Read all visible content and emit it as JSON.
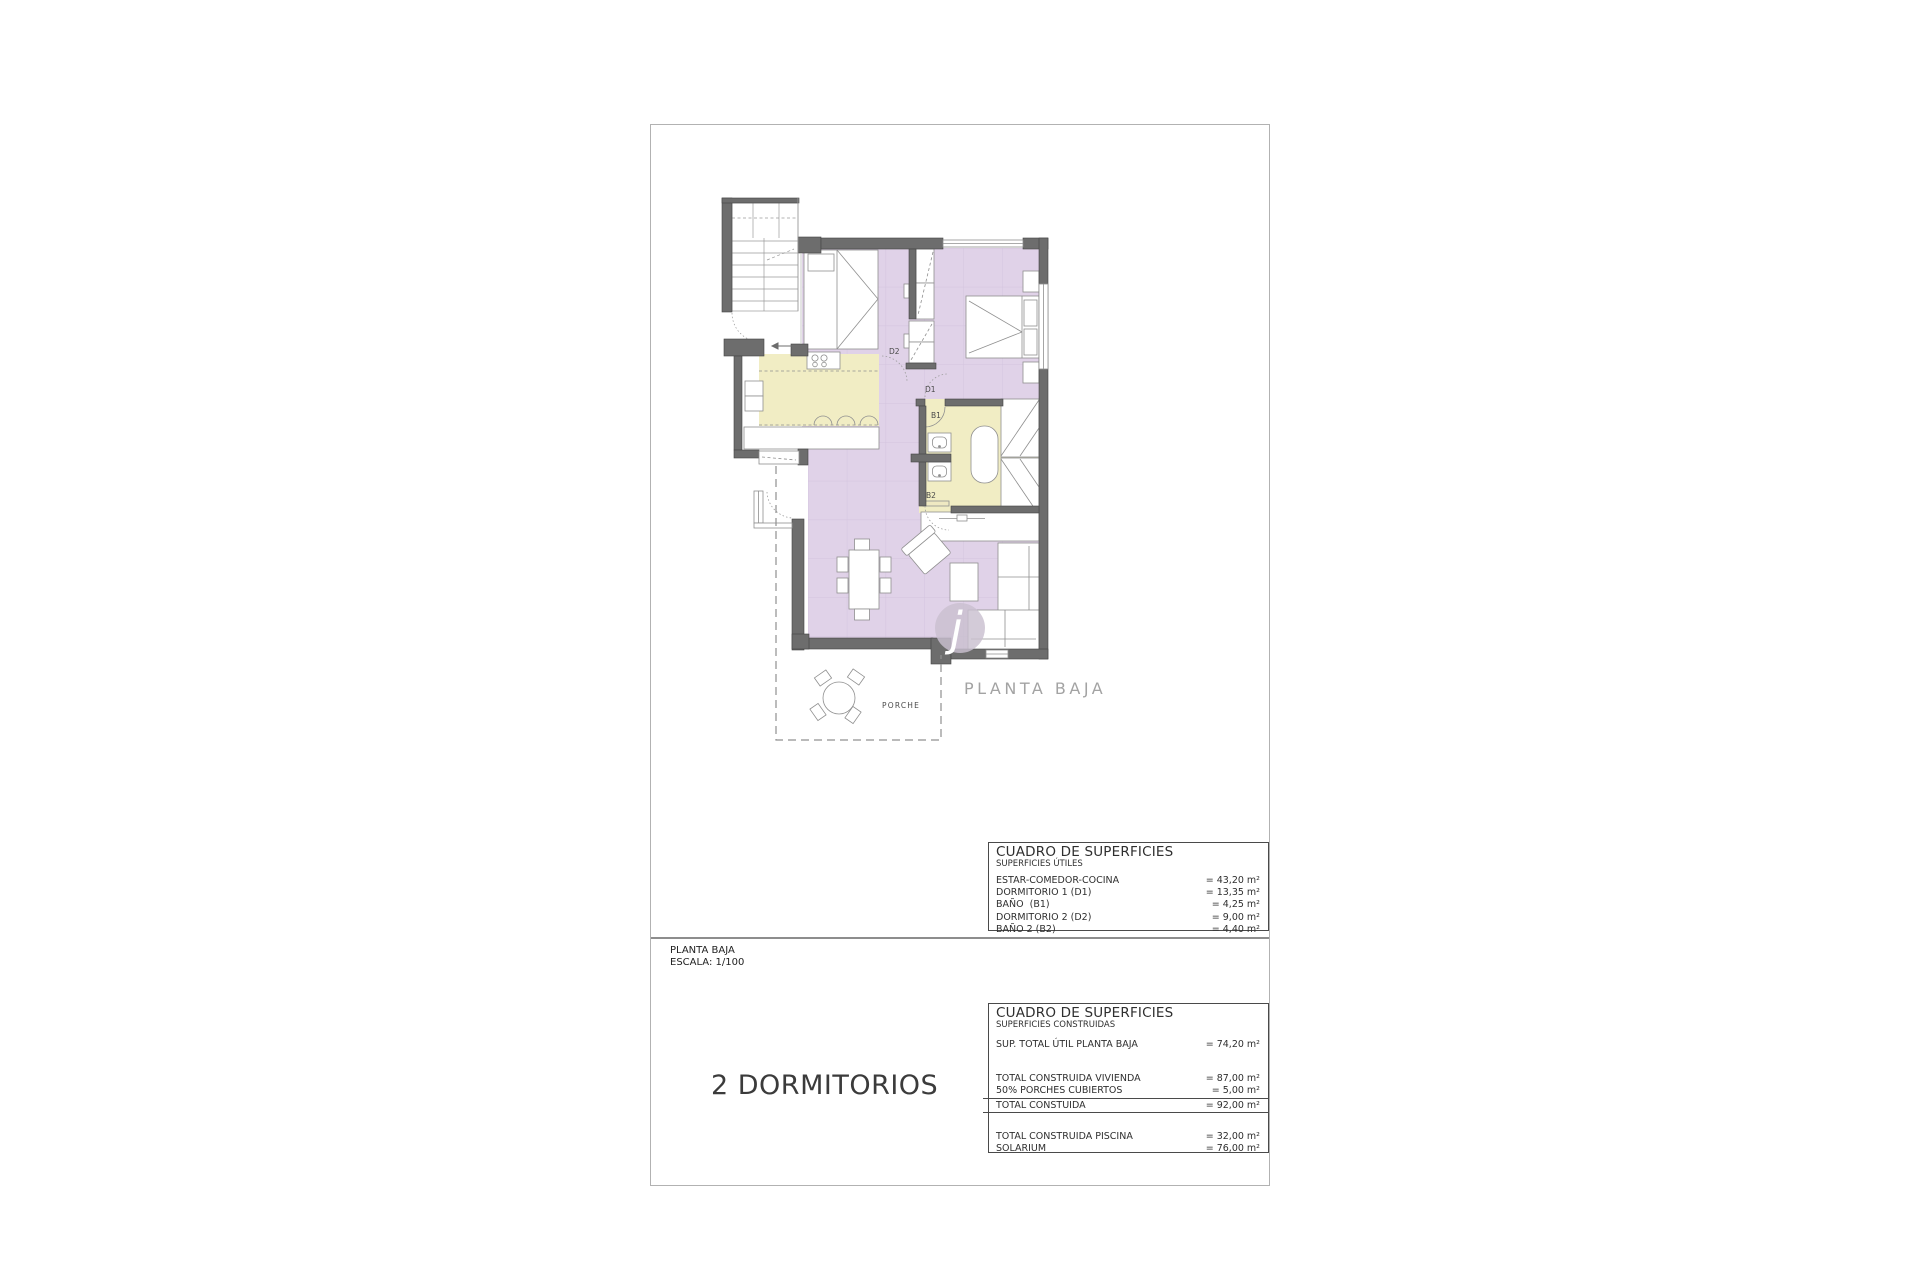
{
  "page": {
    "plan_labels": {
      "d2": "D2",
      "d1": "D1",
      "b1": "B1",
      "b2": "B2"
    },
    "porch_label": "PORCHE",
    "plan_title": "PLANTA BAJA",
    "watermark": "j",
    "footer": {
      "title": "PLANTA BAJA",
      "scale": "ESCALA: 1/100",
      "type_label": "2 DORMITORIOS"
    },
    "table_utiles": {
      "title": "CUADRO DE SUPERFICIES",
      "subtitle": "SUPERFICIES ÚTILES",
      "rows": [
        {
          "label": "ESTAR-COMEDOR-COCINA",
          "value": "= 43,20 m²"
        },
        {
          "label": "DORMITORIO 1 (D1)",
          "value": "= 13,35 m²"
        },
        {
          "label": "BAÑO  (B1)",
          "value": "= 4,25 m²"
        },
        {
          "label": "DORMITORIO 2 (D2)",
          "value": "= 9,00 m²"
        },
        {
          "label": "BAÑO 2 (B2)",
          "value": "= 4,40 m²"
        }
      ]
    },
    "table_construidas": {
      "title": "CUADRO DE SUPERFICIES",
      "subtitle": "SUPERFICIES CONSTRUIDAS",
      "row_sup": {
        "label": "SUP. TOTAL ÚTIL PLANTA BAJA",
        "value": "= 74,20 m²"
      },
      "rows_vivienda": [
        {
          "label": "TOTAL CONSTRUIDA VIVIENDA",
          "value": "= 87,00 m²"
        },
        {
          "label": "50% PORCHES CUBIERTOS",
          "value": "= 5,00 m²"
        }
      ],
      "row_total": {
        "label": "TOTAL CONSTUIDA",
        "value": "= 92,00 m²"
      },
      "rows_piscina": [
        {
          "label": "TOTAL CONSTRUIDA PISCINA",
          "value": "= 32,00 m²"
        },
        {
          "label": "SOLARIUM",
          "value": "= 76,00 m²"
        }
      ]
    },
    "colors": {
      "floor_purple": "#e0d2e8",
      "floor_yellow": "#f1edc4",
      "wall_gray": "#6d6d6d",
      "page_border": "#b2b2b2"
    }
  }
}
